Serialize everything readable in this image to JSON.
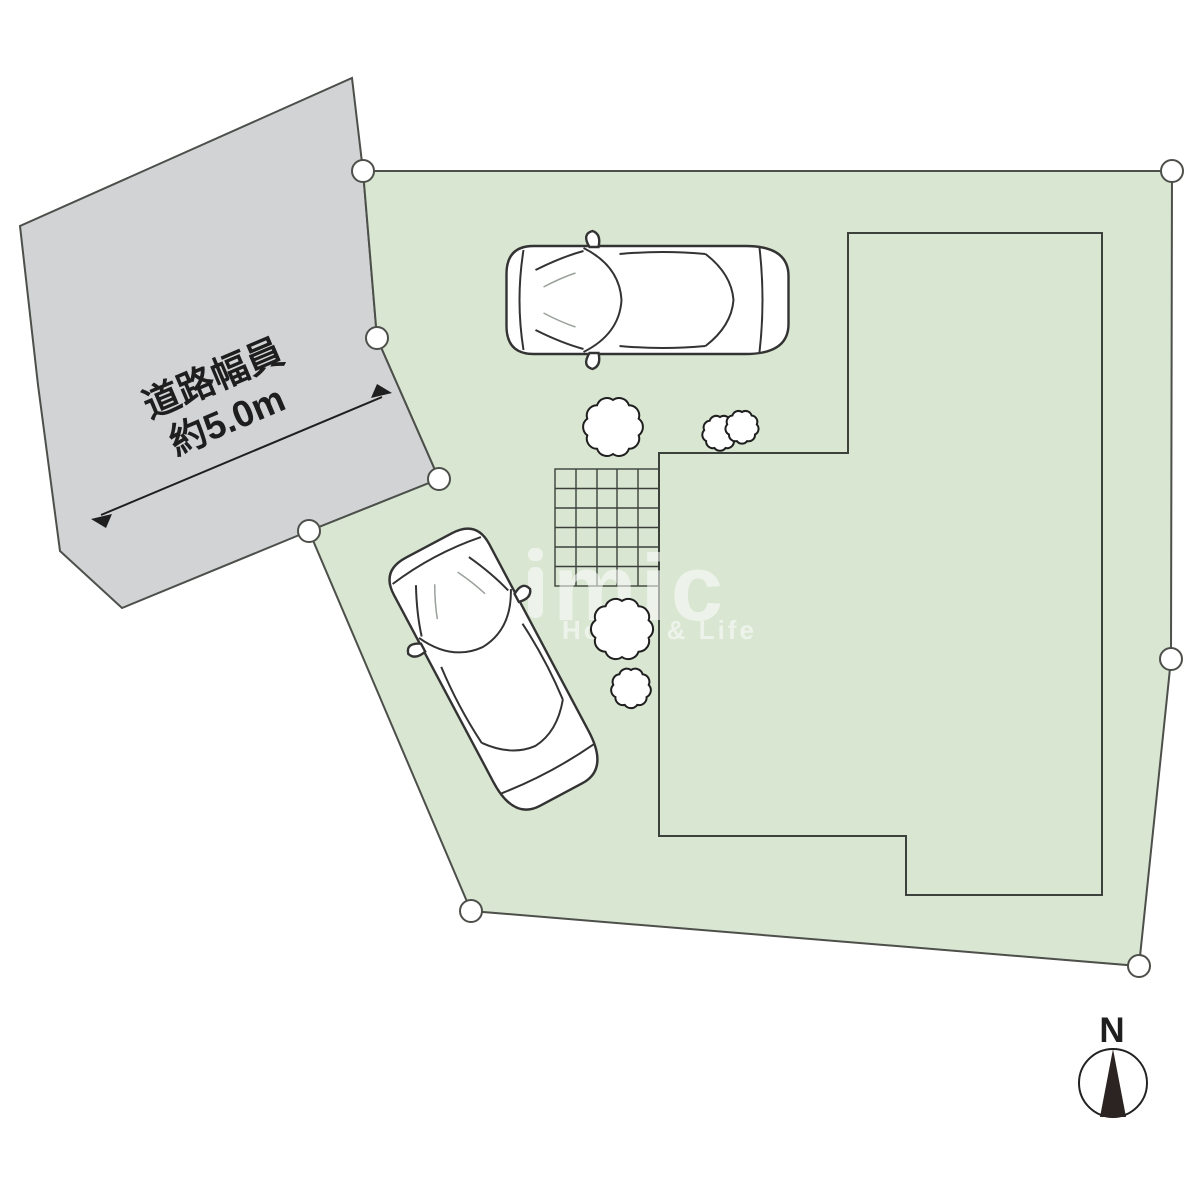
{
  "image_type": "real-estate site plan (区画図)",
  "road": {
    "width_label_line1": "道路幅員",
    "width_label_line2": "約5.0m"
  },
  "compass": {
    "north_label": "N"
  },
  "watermark": {
    "logo_text": "mic",
    "tagline": "House & Life"
  },
  "site": {
    "boundary_marker_count": 8,
    "car_count": 2,
    "tree_count": 4
  },
  "colors": {
    "plot_fill": "#d9e6d1",
    "road_fill": "#d2d3d5",
    "boundary_line": "#4c4f4a",
    "building_line": "#3c413c",
    "label_text": "#1e1e1e",
    "compass_needle": "#2b2422",
    "watermark_white": "#ffffff"
  }
}
